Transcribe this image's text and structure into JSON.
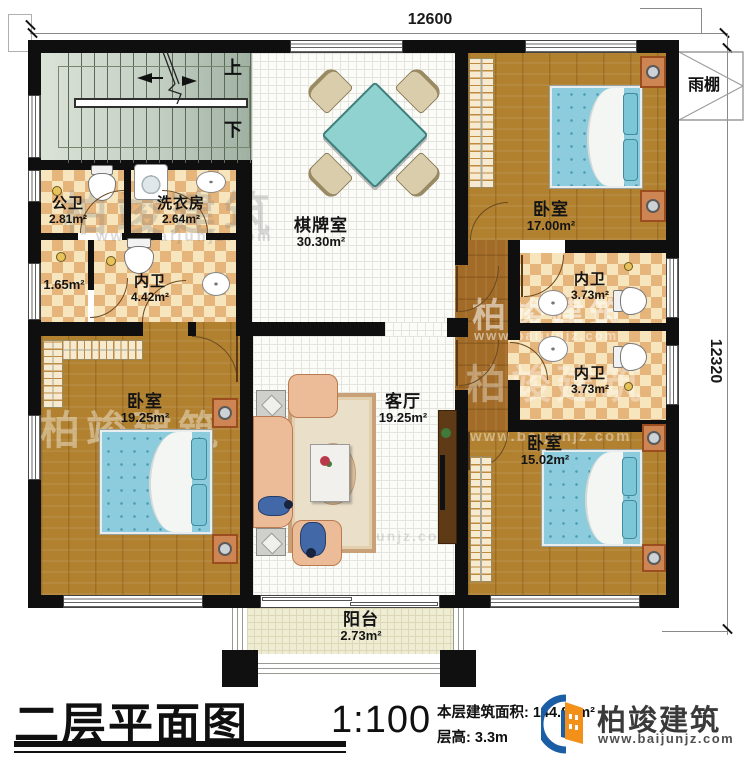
{
  "plan": {
    "dim_top": "12600",
    "dim_right": "12320",
    "stairs_up": "上",
    "stairs_down": "下",
    "canopy": "雨棚",
    "rooms": {
      "gongwei": {
        "name": "公卫",
        "area": "2.81m²"
      },
      "xiyifang": {
        "name": "洗衣房",
        "area": "2.64m²"
      },
      "qipaishi": {
        "name": "棋牌室",
        "area": "30.30m²"
      },
      "bedroom_tr": {
        "name": "卧室",
        "area": "17.00m²"
      },
      "neiwei_main": {
        "name": "内卫",
        "area": "4.42m²"
      },
      "closet": {
        "area": "1.65m²"
      },
      "neiwei_up": {
        "name": "内卫",
        "area": "3.73m²"
      },
      "neiwei_low": {
        "name": "内卫",
        "area": "3.73m²"
      },
      "bedroom_bl": {
        "name": "卧室",
        "area": "19.25m²"
      },
      "keting": {
        "name": "客厅",
        "area": "19.25m²"
      },
      "bedroom_br": {
        "name": "卧室",
        "area": "15.02m²"
      },
      "yangtai": {
        "name": "阳台",
        "area": "2.73m²"
      }
    }
  },
  "footer": {
    "title": "二层平面图",
    "scale": "1:100",
    "area_label": "本层建筑面积:",
    "area_value": "144.88m²",
    "height_label": "层高:",
    "height_value": "3.3m",
    "brand": "柏竣建筑",
    "site": "www.baijunjz.com"
  },
  "watermark": {
    "brand": "柏竣建筑",
    "site": "www.baijunjz.com"
  },
  "colors": {
    "wall": "#0f0f0f",
    "wood": "#b1812f",
    "tile_checker": "#e5b57c",
    "bed_blue": "#8cccdc",
    "table_teal": "#8fd2cf",
    "logo_blue": "#1b5ea6",
    "logo_orange": "#f39019"
  }
}
